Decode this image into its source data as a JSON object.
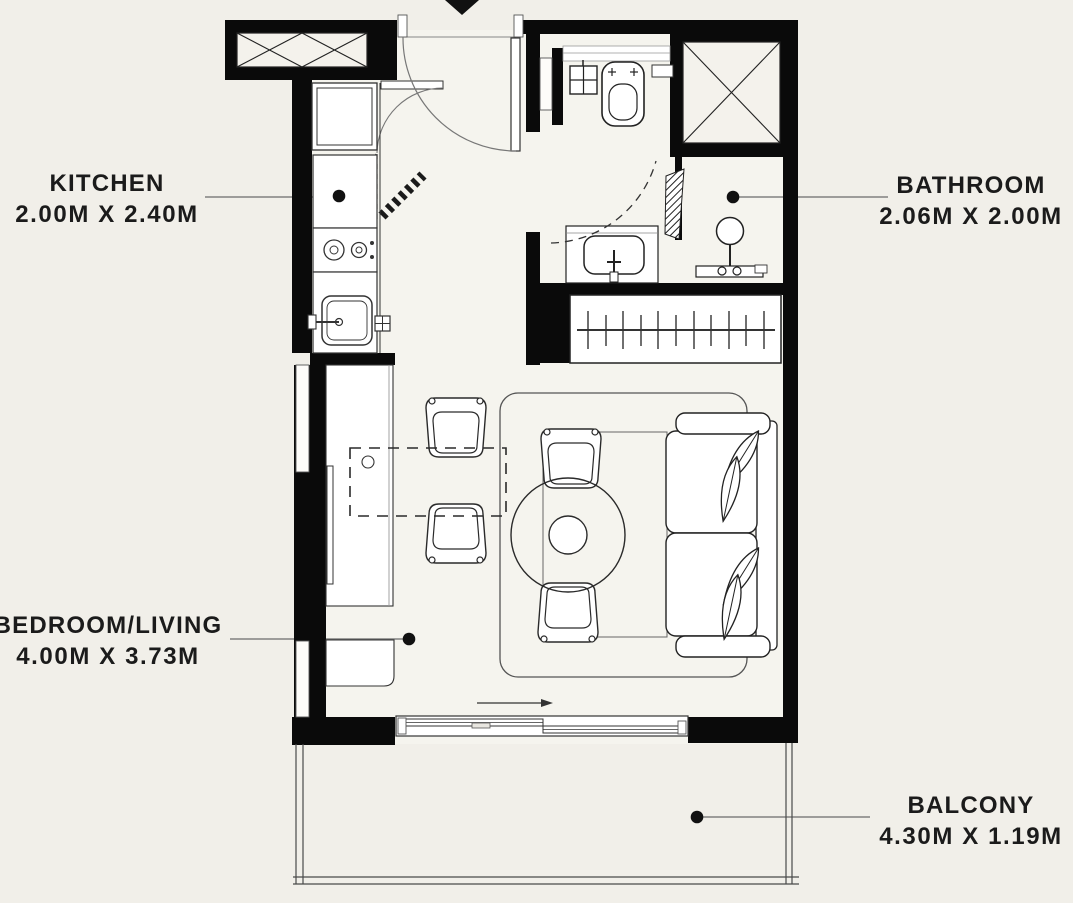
{
  "plan_title": "Studio apartment floor plan",
  "rooms": {
    "kitchen": {
      "name": "KITCHEN",
      "dimensions": "2.00M X 2.40M"
    },
    "bathroom": {
      "name": "BATHROOM",
      "dimensions": "2.06M X 2.00M"
    },
    "bedroom_living": {
      "name": "BEDROOM/LIVING",
      "dimensions": "4.00M X 3.73M"
    },
    "balcony": {
      "name": "BALCONY",
      "dimensions": "4.30M X 1.19M"
    }
  },
  "fixture_icons": [
    "entry-arrow-icon",
    "entry-door-icon",
    "refrigerator-icon",
    "stove-icon",
    "kitchen-sink-icon",
    "toilet-icon",
    "bathroom-sink-icon",
    "shower-icon",
    "wardrobe-icon",
    "desk-counter-icon",
    "dining-table-icon",
    "chair-icon",
    "round-table-icon",
    "sofa-icon",
    "rug-icon",
    "sliding-door-icon",
    "balcony-railing-icon",
    "shaft-cross-icon",
    "leader-dot-icon"
  ],
  "colors": {
    "background": "#f1efe9",
    "floor": "#f5f4ee",
    "wall": "#0a0a0a",
    "line": "#3c3c3c",
    "thin": "#6b6b6b",
    "fixture": "#ffffff",
    "text": "#1b1b1b"
  }
}
